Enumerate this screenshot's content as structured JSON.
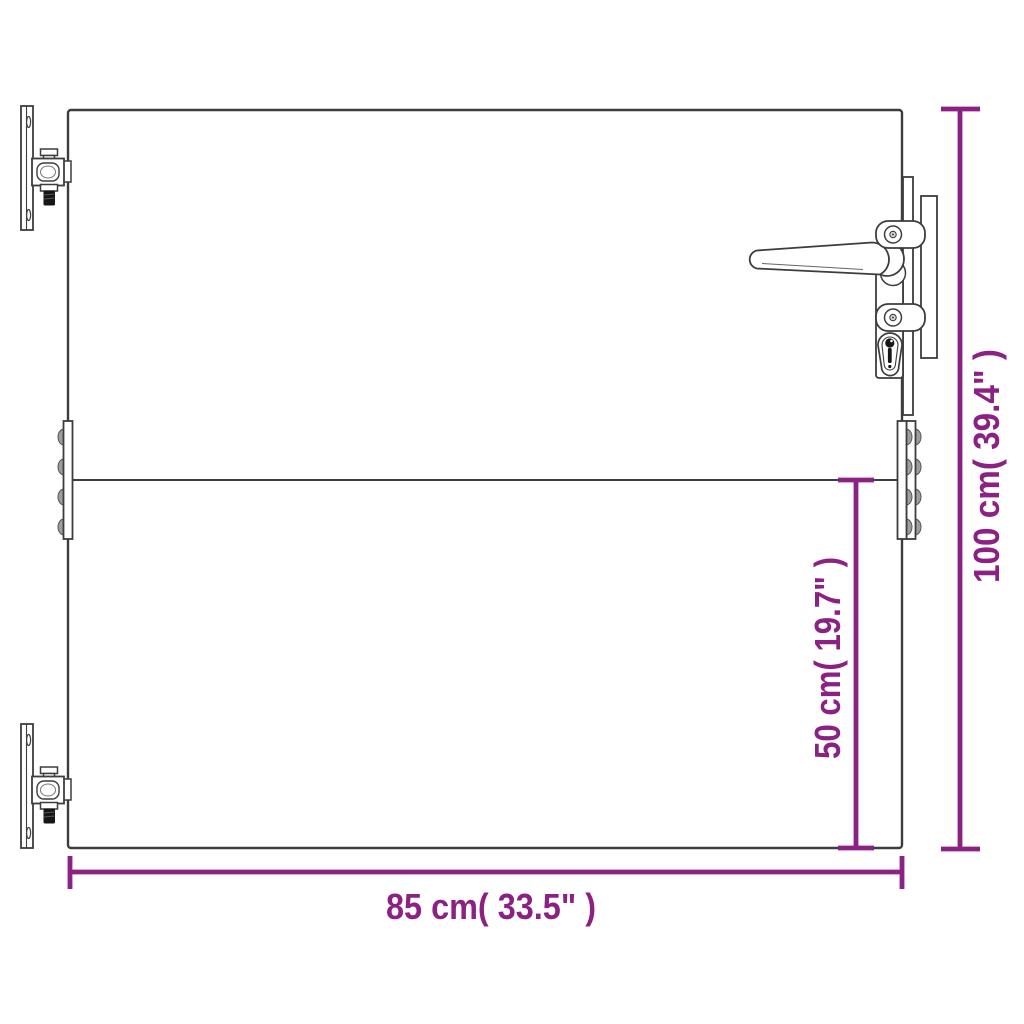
{
  "diagram": {
    "kind": "product-dimension-diagram",
    "subject": "garden gate with hinges, lever handle and euro cylinder lock",
    "colors": {
      "accent": "#8B2182",
      "line": "#3d3d3d",
      "background": "#ffffff",
      "knuckle_fill": "#9e9e9e",
      "bolt_fill": "#161616"
    },
    "dimensions": {
      "height": {
        "label": "100 cm( 39.4\" )",
        "value_cm": 100,
        "value_inch": 39.4
      },
      "inner_height": {
        "label": "50 cm( 19.7\" )",
        "value_cm": 50,
        "value_inch": 19.7
      },
      "width": {
        "label": "85 cm( 33.5\" )",
        "value_cm": 85,
        "value_inch": 33.5
      }
    }
  }
}
